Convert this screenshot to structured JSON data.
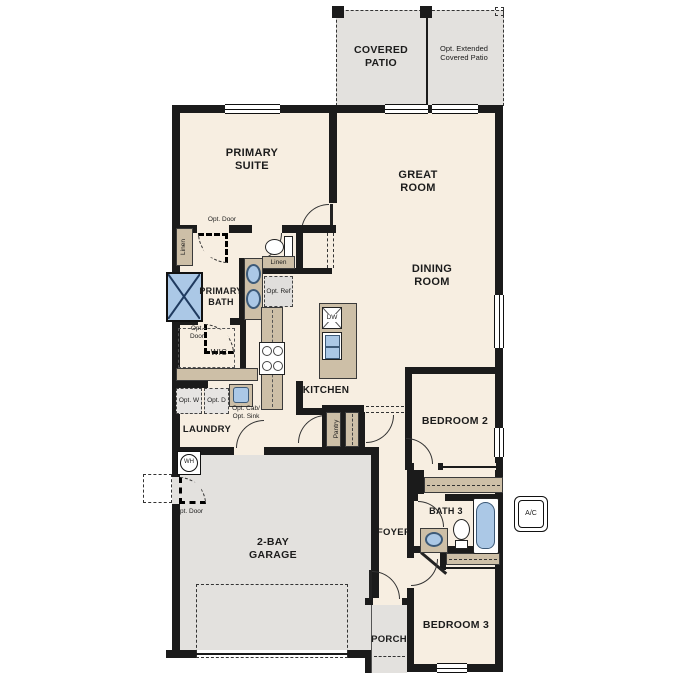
{
  "plan": {
    "outdoor": {
      "covered_patio": "COVERED PATIO",
      "opt_extended_patio": "Opt. Extended Covered Patio",
      "porch": "PORCH"
    },
    "rooms": {
      "primary_suite": "PRIMARY SUITE",
      "great_room": "GREAT ROOM",
      "dining_room": "DINING ROOM",
      "kitchen": "KITCHEN",
      "primary_bath": "PRIMARY BATH",
      "wic": "WIC",
      "laundry": "LAUNDRY",
      "bedroom2": "BEDROOM 2",
      "bedroom3": "BEDROOM 3",
      "bath3": "BATH 3",
      "foyer": "FOYER",
      "garage": "2-BAY GARAGE"
    },
    "closets": {
      "linen_vertical": "Linen",
      "linen_horizontal": "Linen",
      "pantry": "Pantry"
    },
    "options": {
      "opt_door_suite": "Opt. Door",
      "opt_door_wic": "Opt. Door",
      "opt_door_garage": "Opt. Door",
      "opt_ref": "Opt. Ref",
      "opt_washer": "Opt. W",
      "opt_dryer": "Opt. D",
      "opt_cab": "Opt. Cab/",
      "opt_sink": "Opt. Sink"
    },
    "equipment": {
      "dishwasher": "DW",
      "water_heater": "WH",
      "ac_unit": "A/C"
    },
    "colors": {
      "wall": "#1b1b1b",
      "floor": "#f7eee1",
      "outdoor": "#e3e1de",
      "cabinet": "#cdbfa7",
      "fixture_blue": "#abc8e6"
    }
  }
}
